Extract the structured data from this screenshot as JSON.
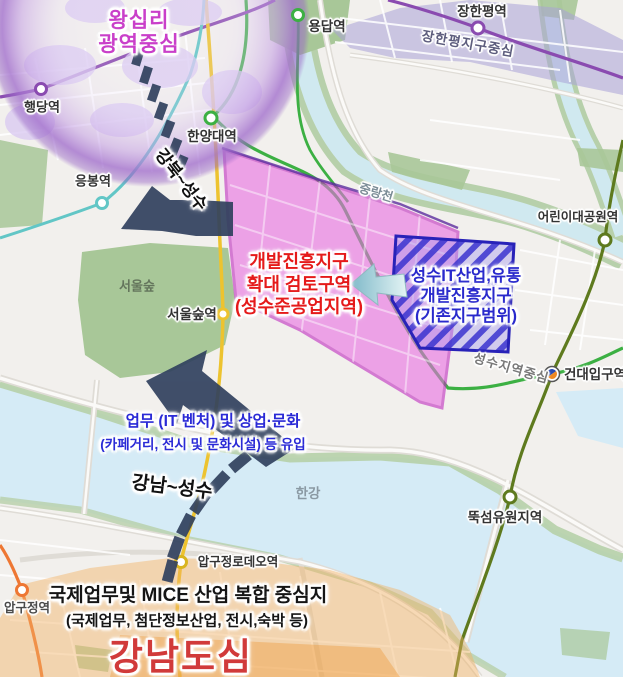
{
  "zones": {
    "wangsimni": {
      "line1": "왕십리",
      "line2": "광역중심"
    },
    "expand": {
      "line1": "개발진흥지구",
      "line2": "확대 검토구역",
      "line3": "(성수준공업지역)"
    },
    "existing": {
      "line1": "성수IT산업,유통",
      "line2": "개발진흥지구",
      "line3": "(기존지구범위)"
    },
    "janghanpyeong_district": "장한평지구중심",
    "seongsu_center": "성수지역중심",
    "gangnam": {
      "mice_line1": "국제업무및 MICE 산업 복합 중심지",
      "mice_line2": "(국제업무, 첨단정보산업, 전시,숙박 등)",
      "title": "강남도심"
    }
  },
  "flows": {
    "gangbuk_seongsu": "강북~성수",
    "gangnam_seongsu": "강남~성수",
    "inflow_line1": "업무 (IT 벤처) 및 상업·문화",
    "inflow_line2": "(카페거리, 전시 및 문화시설) 등 유입"
  },
  "stations": {
    "haengdang": "행당역",
    "hanyang_univ": "한양대역",
    "eungbong": "응봉역",
    "yongdap": "용답역",
    "janghanpyeong": "장한평역",
    "children_grand_park": "어린이대공원역",
    "konkuk_univ": "건대입구역",
    "ttukseom_resort": "뚝섬유원지역",
    "apgujeong_rodeo": "압구정로데오역",
    "apgujeong": "압구정역",
    "seoul_forest": "서울숲역"
  },
  "places": {
    "seoul_forest_park": "서울숲",
    "jungnangcheon": "중랑천",
    "hangang": "한강"
  },
  "colors": {
    "expand_zone_fill": "#ee8ae6",
    "expand_zone_border": "#c02cc0",
    "expand_zone_text": "#e51a1a",
    "existing_zone_stripe": "#3b33cf",
    "existing_zone_text": "#2929cc",
    "flow_arrow": "#31415e",
    "inflow_text": "#2a2ad6",
    "wangsimni_text": "#c93fc9",
    "gangnam_title_text": "#d13a3a",
    "line2_green": "#3cb043",
    "line5_purple": "#8a4bb0",
    "line7_olive": "#5e7a1e",
    "suin_bundang_yellow": "#edc32f",
    "line3_orange": "#ee7733",
    "gyeongui_teal": "#62c6c6"
  }
}
